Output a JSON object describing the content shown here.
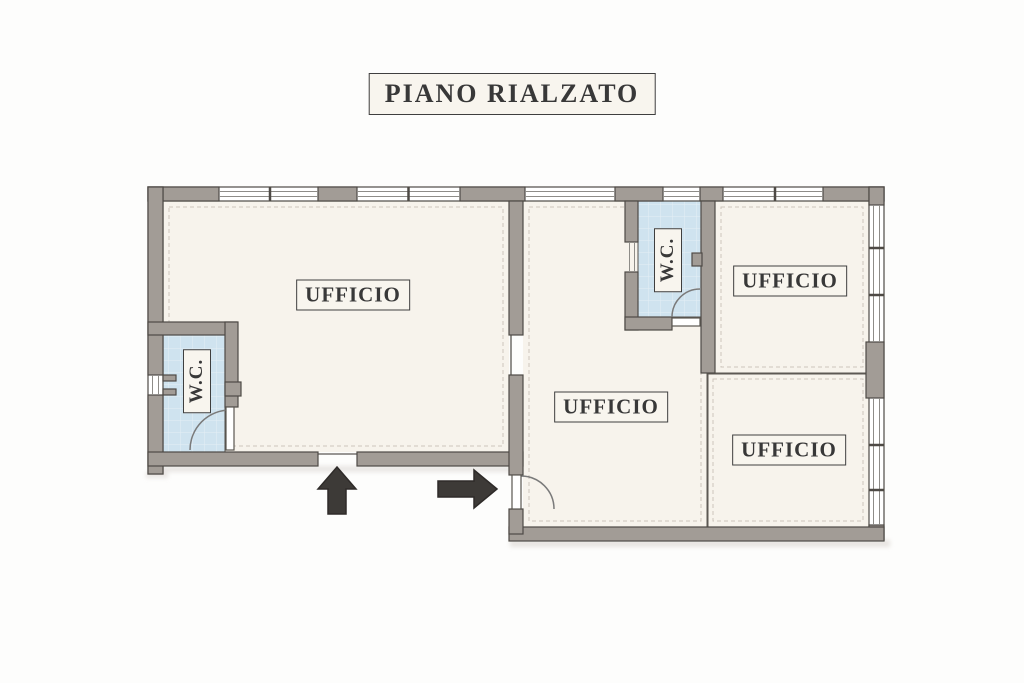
{
  "title": "PIANO RIALZATO",
  "floor_plan": {
    "rooms": [
      {
        "name": "office-left",
        "label": "UFFICIO"
      },
      {
        "name": "office-middle",
        "label": "UFFICIO"
      },
      {
        "name": "office-top-right",
        "label": "UFFICIO"
      },
      {
        "name": "office-bottom-right",
        "label": "UFFICIO"
      },
      {
        "name": "wc-left",
        "label": "W.C."
      },
      {
        "name": "wc-top",
        "label": "W.C."
      }
    ],
    "icons": [
      {
        "name": "entrance-arrow-up-icon",
        "meaning": "entrance direction up"
      },
      {
        "name": "entrance-arrow-right-icon",
        "meaning": "entrance direction right"
      }
    ],
    "colors": {
      "wall": "#a29c96",
      "wall_edge": "#4e4a45",
      "floor": "#f7f3ec",
      "wc_tile": "#cfe3ef",
      "label_background": "#f8f5ee",
      "label_border": "#3f3f3f",
      "text": "#383838",
      "arrow": "#3d3a37",
      "page_background": "#fdfdfc"
    }
  }
}
